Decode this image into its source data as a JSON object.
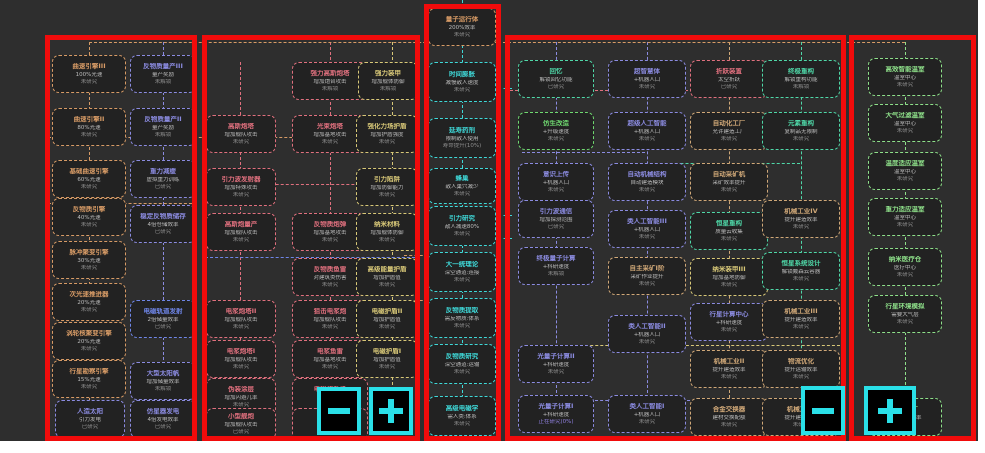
{
  "app": {
    "description": "tech-tree research screen with red region highlights and zoom controls",
    "background": "#2e2e2e",
    "highlight_color": "#f10b0b",
    "accent_color": "#2ae0e8"
  },
  "palette": {
    "orange": "#d79b66",
    "purple": "#8b8be0",
    "blue": "#6f86e8",
    "pink": "#e0707e",
    "yellow": "#d8c878",
    "cyan": "#3fd8d8",
    "green": "#6fd870",
    "teal": "#4fd8a8",
    "tan": "#d0a878",
    "lime": "#8ee08a",
    "progress": "#9080e0"
  },
  "groups": [
    {
      "name": "group-engines",
      "x": 45,
      "y": 35,
      "w": 152,
      "h": 406
    },
    {
      "name": "group-weapons",
      "x": 202,
      "y": 35,
      "w": 218,
      "h": 406
    },
    {
      "name": "group-core",
      "x": 424,
      "y": 4,
      "w": 77,
      "h": 437
    },
    {
      "name": "group-industry",
      "x": 505,
      "y": 35,
      "w": 341,
      "h": 406
    },
    {
      "name": "group-habitat",
      "x": 849,
      "y": 35,
      "w": 127,
      "h": 406
    }
  ],
  "buttons": [
    {
      "name": "zoom-out-button",
      "glyph": "minus",
      "x": 317,
      "y": 387,
      "w": 44,
      "h": 48
    },
    {
      "name": "zoom-in-button",
      "glyph": "plus",
      "x": 369,
      "y": 387,
      "w": 44,
      "h": 48
    },
    {
      "name": "zoom-out-button-2",
      "glyph": "minus",
      "x": 801,
      "y": 386,
      "w": 44,
      "h": 49
    },
    {
      "name": "zoom-in-button-2",
      "glyph": "plus",
      "x": 864,
      "y": 386,
      "w": 52,
      "h": 49
    }
  ],
  "edges": [
    {
      "o": "v",
      "x": 89,
      "y1": 42,
      "y2": 400,
      "c": "orange"
    },
    {
      "o": "v",
      "x": 163,
      "y1": 42,
      "y2": 400,
      "c": "purple"
    },
    {
      "o": "v",
      "x": 240,
      "y1": 62,
      "y2": 420,
      "c": "pink"
    },
    {
      "o": "v",
      "x": 330,
      "y1": 42,
      "y2": 420,
      "c": "pink"
    },
    {
      "o": "v",
      "x": 392,
      "y1": 42,
      "y2": 420,
      "c": "yellow"
    },
    {
      "o": "v",
      "x": 462,
      "y1": 0,
      "y2": 438,
      "c": "cyan"
    },
    {
      "o": "v",
      "x": 556,
      "y1": 42,
      "y2": 398,
      "c": "purple"
    },
    {
      "o": "v",
      "x": 647,
      "y1": 42,
      "y2": 398,
      "c": "purple"
    },
    {
      "o": "v",
      "x": 729,
      "y1": 42,
      "y2": 398,
      "c": "tan"
    },
    {
      "o": "v",
      "x": 801,
      "y1": 42,
      "y2": 398,
      "c": "teal"
    },
    {
      "o": "v",
      "x": 905,
      "y1": 42,
      "y2": 400,
      "c": "lime"
    },
    {
      "o": "h",
      "y": 42,
      "x1": 89,
      "x2": 905,
      "c": "orange"
    },
    {
      "o": "h",
      "y": 137,
      "x1": 48,
      "x2": 418,
      "c": "orange"
    },
    {
      "o": "h",
      "y": 203,
      "x1": 48,
      "x2": 197,
      "c": "orange"
    },
    {
      "o": "h",
      "y": 184,
      "x1": 205,
      "x2": 420,
      "c": "pink"
    },
    {
      "o": "h",
      "y": 257,
      "x1": 205,
      "x2": 420,
      "c": "blue"
    },
    {
      "o": "h",
      "y": 90,
      "x1": 505,
      "x2": 688,
      "c": "pink"
    },
    {
      "o": "h",
      "y": 152,
      "x1": 522,
      "x2": 645,
      "c": "purple"
    },
    {
      "o": "h",
      "y": 163,
      "x1": 650,
      "x2": 800,
      "c": "teal"
    },
    {
      "o": "h",
      "y": 313,
      "x1": 692,
      "x2": 845,
      "c": "teal"
    },
    {
      "o": "h",
      "y": 345,
      "x1": 560,
      "x2": 845,
      "c": "yellow"
    },
    {
      "o": "h",
      "y": 400,
      "x1": 595,
      "x2": 690,
      "c": "purple"
    },
    {
      "o": "h",
      "y": 255,
      "x1": 404,
      "x2": 428,
      "c": "orange"
    },
    {
      "o": "h",
      "y": 300,
      "x1": 404,
      "x2": 428,
      "c": "orange"
    },
    {
      "o": "h",
      "y": 88,
      "x1": 498,
      "x2": 512,
      "c": "cyan"
    },
    {
      "o": "h",
      "y": 215,
      "x1": 498,
      "x2": 512,
      "c": "cyan"
    },
    {
      "o": "h",
      "y": 238,
      "x1": 498,
      "x2": 512,
      "c": "cyan"
    }
  ],
  "nodes": [
    {
      "x": 52,
      "y": 55,
      "w": 74,
      "h": 38,
      "c": "orange",
      "title": "曲速引擎III",
      "effect": "100%光速",
      "status": "未研究"
    },
    {
      "x": 52,
      "y": 108,
      "w": 74,
      "h": 38,
      "c": "orange",
      "title": "曲速引擎II",
      "effect": "80%光速",
      "status": "未研究"
    },
    {
      "x": 52,
      "y": 160,
      "w": 74,
      "h": 38,
      "c": "orange",
      "title": "基础曲速引擎",
      "effect": "60%光速",
      "status": "未研究"
    },
    {
      "x": 52,
      "y": 198,
      "w": 74,
      "h": 38,
      "c": "orange",
      "title": "反物质引擎",
      "effect": "40%光速",
      "status": "未研究"
    },
    {
      "x": 52,
      "y": 241,
      "w": 74,
      "h": 38,
      "c": "orange",
      "title": "脉冲聚变引擎",
      "effect": "30%光速",
      "status": "未研究"
    },
    {
      "x": 52,
      "y": 283,
      "w": 74,
      "h": 38,
      "c": "orange",
      "title": "次光速推进器",
      "effect": "20%光速",
      "status": "未研究"
    },
    {
      "x": 52,
      "y": 322,
      "w": 74,
      "h": 38,
      "c": "orange",
      "title": "涡轮核聚变引擎",
      "effect": "20%光速",
      "status": "未研究"
    },
    {
      "x": 52,
      "y": 360,
      "w": 74,
      "h": 38,
      "c": "orange",
      "title": "行星勘察引擎",
      "effect": "15%光速",
      "status": "未研究"
    },
    {
      "x": 55,
      "y": 400,
      "w": 70,
      "h": 38,
      "c": "purple",
      "title": "人造太阳",
      "effect": "引力发电",
      "status": "已研究"
    },
    {
      "x": 130,
      "y": 55,
      "w": 66,
      "h": 38,
      "c": "purple",
      "title": "反物质量产III",
      "effect": "量产奖励",
      "status": "未解锁"
    },
    {
      "x": 130,
      "y": 108,
      "w": 66,
      "h": 38,
      "c": "purple",
      "title": "反物质量产II",
      "effect": "量产奖励",
      "status": "未解锁"
    },
    {
      "x": 130,
      "y": 160,
      "w": 66,
      "h": 38,
      "c": "purple",
      "title": "重力减缓",
      "effect": "虚拟重力训练",
      "status": "已研究"
    },
    {
      "x": 130,
      "y": 205,
      "w": 66,
      "h": 38,
      "c": "purple",
      "title": "稳定反物质储存",
      "effect": "4倍仓储效率",
      "status": "已研究"
    },
    {
      "x": 130,
      "y": 300,
      "w": 66,
      "h": 38,
      "c": "blue",
      "title": "电磁轨道发射",
      "effect": "2倍储量效率",
      "status": "已研究"
    },
    {
      "x": 130,
      "y": 362,
      "w": 66,
      "h": 38,
      "c": "purple",
      "title": "大型太阳帆",
      "effect": "增加储量效率",
      "status": "未解锁"
    },
    {
      "x": 130,
      "y": 400,
      "w": 66,
      "h": 38,
      "c": "purple",
      "title": "仿星器发电",
      "effect": "4倍发电效率",
      "status": "已研究"
    },
    {
      "x": 292,
      "y": 62,
      "w": 76,
      "h": 38,
      "c": "pink",
      "title": "强力高斯炮塔",
      "effect": "增加炮台攻击",
      "status": "未解锁"
    },
    {
      "x": 358,
      "y": 62,
      "w": 60,
      "h": 38,
      "c": "yellow",
      "title": "强力装甲",
      "effect": "增加舰体防御",
      "status": "未解锁"
    },
    {
      "x": 206,
      "y": 115,
      "w": 70,
      "h": 38,
      "c": "pink",
      "title": "高斯炮塔",
      "effect": "增加舰队攻击",
      "status": "未研究"
    },
    {
      "x": 292,
      "y": 115,
      "w": 76,
      "h": 38,
      "c": "pink",
      "title": "光束炮塔",
      "effect": "增加基地攻击",
      "status": "未研究"
    },
    {
      "x": 356,
      "y": 115,
      "w": 62,
      "h": 38,
      "c": "yellow",
      "title": "强化力场护盾",
      "effect": "增加护盾强度",
      "status": "未研究"
    },
    {
      "x": 206,
      "y": 168,
      "w": 70,
      "h": 38,
      "c": "pink",
      "title": "引力波发射器",
      "effect": "增加特殊攻击",
      "status": "未研究"
    },
    {
      "x": 356,
      "y": 168,
      "w": 62,
      "h": 38,
      "c": "yellow",
      "title": "引力陷阱",
      "effect": "增加防御能力",
      "status": "未研究"
    },
    {
      "x": 206,
      "y": 213,
      "w": 70,
      "h": 38,
      "c": "pink",
      "title": "高斯炮量产",
      "effect": "增加舰队攻击",
      "status": "未研究"
    },
    {
      "x": 292,
      "y": 213,
      "w": 76,
      "h": 38,
      "c": "pink",
      "title": "反物质炮弹",
      "effect": "增加基地攻击",
      "status": "未研究"
    },
    {
      "x": 356,
      "y": 213,
      "w": 62,
      "h": 38,
      "c": "yellow",
      "title": "纳米材料",
      "effect": "增加舰体防御",
      "status": "未研究"
    },
    {
      "x": 292,
      "y": 258,
      "w": 76,
      "h": 38,
      "c": "pink",
      "title": "反物质鱼雷",
      "effect": "对建筑类伤害",
      "status": "未研究"
    },
    {
      "x": 356,
      "y": 258,
      "w": 62,
      "h": 38,
      "c": "yellow",
      "title": "高级能量护盾",
      "effect": "增加护盾值",
      "status": "未研究"
    },
    {
      "x": 206,
      "y": 300,
      "w": 70,
      "h": 38,
      "c": "pink",
      "title": "电浆炮塔II",
      "effect": "增加舰队攻击",
      "status": "未研究"
    },
    {
      "x": 292,
      "y": 300,
      "w": 76,
      "h": 38,
      "c": "pink",
      "title": "狙击电浆炮",
      "effect": "增加舰队攻击",
      "status": "未研究"
    },
    {
      "x": 356,
      "y": 300,
      "w": 62,
      "h": 38,
      "c": "yellow",
      "title": "电磁护盾II",
      "effect": "增加护盾值",
      "status": "未研究"
    },
    {
      "x": 206,
      "y": 340,
      "w": 70,
      "h": 38,
      "c": "pink",
      "title": "电浆炮塔I",
      "effect": "增加舰队攻击",
      "status": "未研究"
    },
    {
      "x": 292,
      "y": 340,
      "w": 76,
      "h": 38,
      "c": "pink",
      "title": "电浆鱼雷",
      "effect": "增加基地攻击",
      "status": "未研究"
    },
    {
      "x": 356,
      "y": 340,
      "w": 62,
      "h": 38,
      "c": "yellow",
      "title": "电磁护盾I",
      "effect": "增加护盾值",
      "status": "未研究"
    },
    {
      "x": 206,
      "y": 378,
      "w": 70,
      "h": 38,
      "c": "pink",
      "title": "伪装涂层",
      "effect": "增加闪避几率",
      "status": "未研究"
    },
    {
      "x": 292,
      "y": 378,
      "w": 76,
      "h": 38,
      "c": "pink",
      "title": "电磁炮升级",
      "effect": "增加攻击",
      "status": "未研究"
    },
    {
      "x": 206,
      "y": 408,
      "w": 70,
      "h": 32,
      "c": "pink",
      "title": "小型舰炮",
      "effect": "增加舰队攻击",
      "status": "已研究"
    },
    {
      "x": 292,
      "y": 408,
      "w": 76,
      "h": 32,
      "c": "pink",
      "title": "涂装工艺",
      "effect": "增加防御",
      "status": "已研究"
    },
    {
      "x": 428,
      "y": 8,
      "w": 68,
      "h": 38,
      "c": "orange",
      "title": "量子运行体",
      "effect": "200%效率",
      "status": "未研究"
    },
    {
      "x": 428,
      "y": 62,
      "w": 68,
      "h": 40,
      "c": "cyan",
      "title": "时间膨胀",
      "effect": "减慢敌人速度",
      "status": "未研究"
    },
    {
      "x": 428,
      "y": 118,
      "w": 68,
      "h": 40,
      "c": "cyan",
      "title": "延寿药剂",
      "effect": "限制敌人使用",
      "status": "寿命提升(10%)"
    },
    {
      "x": 428,
      "y": 168,
      "w": 68,
      "h": 36,
      "c": "cyan",
      "title": "蜂巢",
      "effect": "敌人巢穴减少",
      "status": "未研究"
    },
    {
      "x": 428,
      "y": 206,
      "w": 68,
      "h": 40,
      "c": "cyan",
      "title": "引力研究",
      "effect": "敌人减速80%",
      "status": "未研究"
    },
    {
      "x": 428,
      "y": 252,
      "w": 68,
      "h": 40,
      "c": "cyan",
      "title": "大一统理论",
      "effect": "深空通道:连接",
      "status": "未研究"
    },
    {
      "x": 428,
      "y": 298,
      "w": 68,
      "h": 40,
      "c": "cyan",
      "title": "反物质提取",
      "effect": "需反物质:体系",
      "status": "未研究"
    },
    {
      "x": 428,
      "y": 344,
      "w": 68,
      "h": 40,
      "c": "cyan",
      "title": "反物质研究",
      "effect": "深空通道:运输",
      "status": "未研究"
    },
    {
      "x": 428,
      "y": 396,
      "w": 68,
      "h": 40,
      "c": "cyan",
      "title": "高级电磁学",
      "effect": "需人类:体系",
      "status": "未研究"
    },
    {
      "x": 518,
      "y": 60,
      "w": 76,
      "h": 38,
      "c": "teal",
      "title": "回忆",
      "effect": "解锁回忆功能",
      "status": "已研究"
    },
    {
      "x": 518,
      "y": 112,
      "w": 76,
      "h": 38,
      "c": "green",
      "title": "仿生改造",
      "effect": "+升级速度",
      "status": "未研究"
    },
    {
      "x": 518,
      "y": 163,
      "w": 76,
      "h": 38,
      "c": "purple",
      "title": "意识上传",
      "effect": "+机器人口",
      "status": "未研究"
    },
    {
      "x": 518,
      "y": 200,
      "w": 76,
      "h": 38,
      "c": "purple",
      "title": "引力波通信",
      "effect": "增加探测范围",
      "status": "已研究"
    },
    {
      "x": 518,
      "y": 247,
      "w": 76,
      "h": 38,
      "c": "purple",
      "title": "终极量子计算",
      "effect": "+科研速度",
      "status": "未解锁"
    },
    {
      "x": 518,
      "y": 345,
      "w": 76,
      "h": 38,
      "c": "purple",
      "title": "光量子计算II",
      "effect": "+科研速度",
      "status": "未研究"
    },
    {
      "x": 518,
      "y": 395,
      "w": 76,
      "h": 38,
      "c": "purple",
      "title": "光量子计算I",
      "effect": "+科研速度",
      "status": "正在研究(0%)",
      "sc": "progress"
    },
    {
      "x": 608,
      "y": 60,
      "w": 78,
      "h": 38,
      "c": "purple",
      "title": "超智慧体",
      "effect": "+机器人口",
      "status": "未研究"
    },
    {
      "x": 608,
      "y": 112,
      "w": 78,
      "h": 38,
      "c": "purple",
      "title": "超级人工智能",
      "effect": "+机器人口",
      "status": "未研究"
    },
    {
      "x": 608,
      "y": 163,
      "w": 78,
      "h": 38,
      "c": "purple",
      "title": "自动机械结构",
      "effect": "自动建造模块",
      "status": "未研究"
    },
    {
      "x": 608,
      "y": 210,
      "w": 78,
      "h": 38,
      "c": "purple",
      "title": "类人工智能III",
      "effect": "+机器人口",
      "status": "未研究"
    },
    {
      "x": 608,
      "y": 257,
      "w": 78,
      "h": 38,
      "c": "tan",
      "title": "自主采矿I阶",
      "effect": "采矿作业提升",
      "status": "未研究"
    },
    {
      "x": 608,
      "y": 315,
      "w": 78,
      "h": 38,
      "c": "purple",
      "title": "类人工智能II",
      "effect": "+机器人口",
      "status": "未研究"
    },
    {
      "x": 608,
      "y": 395,
      "w": 78,
      "h": 38,
      "c": "purple",
      "title": "类人工智能I",
      "effect": "+机器人口",
      "status": "未研究"
    },
    {
      "x": 690,
      "y": 60,
      "w": 78,
      "h": 38,
      "c": "pink",
      "title": "折跃装置",
      "effect": "太空折跃",
      "status": "已研究"
    },
    {
      "x": 690,
      "y": 112,
      "w": 78,
      "h": 38,
      "c": "tan",
      "title": "自动化工厂",
      "effect": "允许建造工厂",
      "status": "未研究"
    },
    {
      "x": 690,
      "y": 163,
      "w": 78,
      "h": 38,
      "c": "tan",
      "title": "自动采矿机",
      "effect": "采矿效率提升",
      "status": "未研究"
    },
    {
      "x": 690,
      "y": 212,
      "w": 78,
      "h": 38,
      "c": "teal",
      "title": "恒星重构",
      "effect": "质量云收集",
      "status": "未研究"
    },
    {
      "x": 690,
      "y": 258,
      "w": 78,
      "h": 38,
      "c": "yellow",
      "title": "纳米装甲III",
      "effect": "增加基地防御",
      "status": "未研究"
    },
    {
      "x": 690,
      "y": 303,
      "w": 78,
      "h": 38,
      "c": "purple",
      "title": "行星计算中心",
      "effect": "+科研速度",
      "status": "未研究"
    },
    {
      "x": 690,
      "y": 350,
      "w": 78,
      "h": 38,
      "c": "tan",
      "title": "机械工业II",
      "effect": "提升建造效率",
      "status": "未研究"
    },
    {
      "x": 690,
      "y": 398,
      "w": 78,
      "h": 38,
      "c": "tan",
      "title": "合金交换器",
      "effect": "建材交换配额",
      "status": "未研究"
    },
    {
      "x": 762,
      "y": 60,
      "w": 78,
      "h": 38,
      "c": "teal",
      "title": "终极重构",
      "effect": "解锁重构功能",
      "status": "未解锁"
    },
    {
      "x": 762,
      "y": 112,
      "w": 78,
      "h": 38,
      "c": "teal",
      "title": "元素重构",
      "effect": "复制品无限制",
      "status": "未研究"
    },
    {
      "x": 762,
      "y": 200,
      "w": 78,
      "h": 38,
      "c": "tan",
      "title": "机械工业IV",
      "effect": "提升建造效率",
      "status": "未研究"
    },
    {
      "x": 762,
      "y": 252,
      "w": 78,
      "h": 38,
      "c": "teal",
      "title": "恒星系统设计",
      "effect": "解锁戴森云容器",
      "status": "未研究"
    },
    {
      "x": 762,
      "y": 300,
      "w": 78,
      "h": 38,
      "c": "tan",
      "title": "机械工业III",
      "effect": "提升建造效率",
      "status": "未研究"
    },
    {
      "x": 762,
      "y": 350,
      "w": 78,
      "h": 38,
      "c": "tan",
      "title": "物流优化",
      "effect": "提升运输效率",
      "status": "未研究"
    },
    {
      "x": 762,
      "y": 398,
      "w": 78,
      "h": 38,
      "c": "tan",
      "title": "机械工业I",
      "effect": "提升建造效率",
      "status": "未研究"
    },
    {
      "x": 868,
      "y": 58,
      "w": 74,
      "h": 38,
      "c": "lime",
      "title": "高效智能温室",
      "effect": "温室中心",
      "status": "未研究"
    },
    {
      "x": 868,
      "y": 104,
      "w": 74,
      "h": 38,
      "c": "lime",
      "title": "大气过滤温室",
      "effect": "温室中心",
      "status": "未研究"
    },
    {
      "x": 868,
      "y": 152,
      "w": 74,
      "h": 38,
      "c": "lime",
      "title": "温度适应温室",
      "effect": "温室中心",
      "status": "未研究"
    },
    {
      "x": 868,
      "y": 198,
      "w": 74,
      "h": 38,
      "c": "lime",
      "title": "重力适应温室",
      "effect": "温室中心",
      "status": "未研究"
    },
    {
      "x": 868,
      "y": 248,
      "w": 74,
      "h": 38,
      "c": "lime",
      "title": "纳米医疗仓",
      "effect": "医疗中心",
      "status": "未研究"
    },
    {
      "x": 868,
      "y": 295,
      "w": 74,
      "h": 38,
      "c": "lime",
      "title": "行星环境模拟",
      "effect": "需要大气层",
      "status": "未研究"
    },
    {
      "x": 868,
      "y": 398,
      "w": 74,
      "h": 38,
      "c": "lime",
      "title": "机械工厂",
      "effect": "提升建造效率",
      "status": "未研究"
    }
  ]
}
